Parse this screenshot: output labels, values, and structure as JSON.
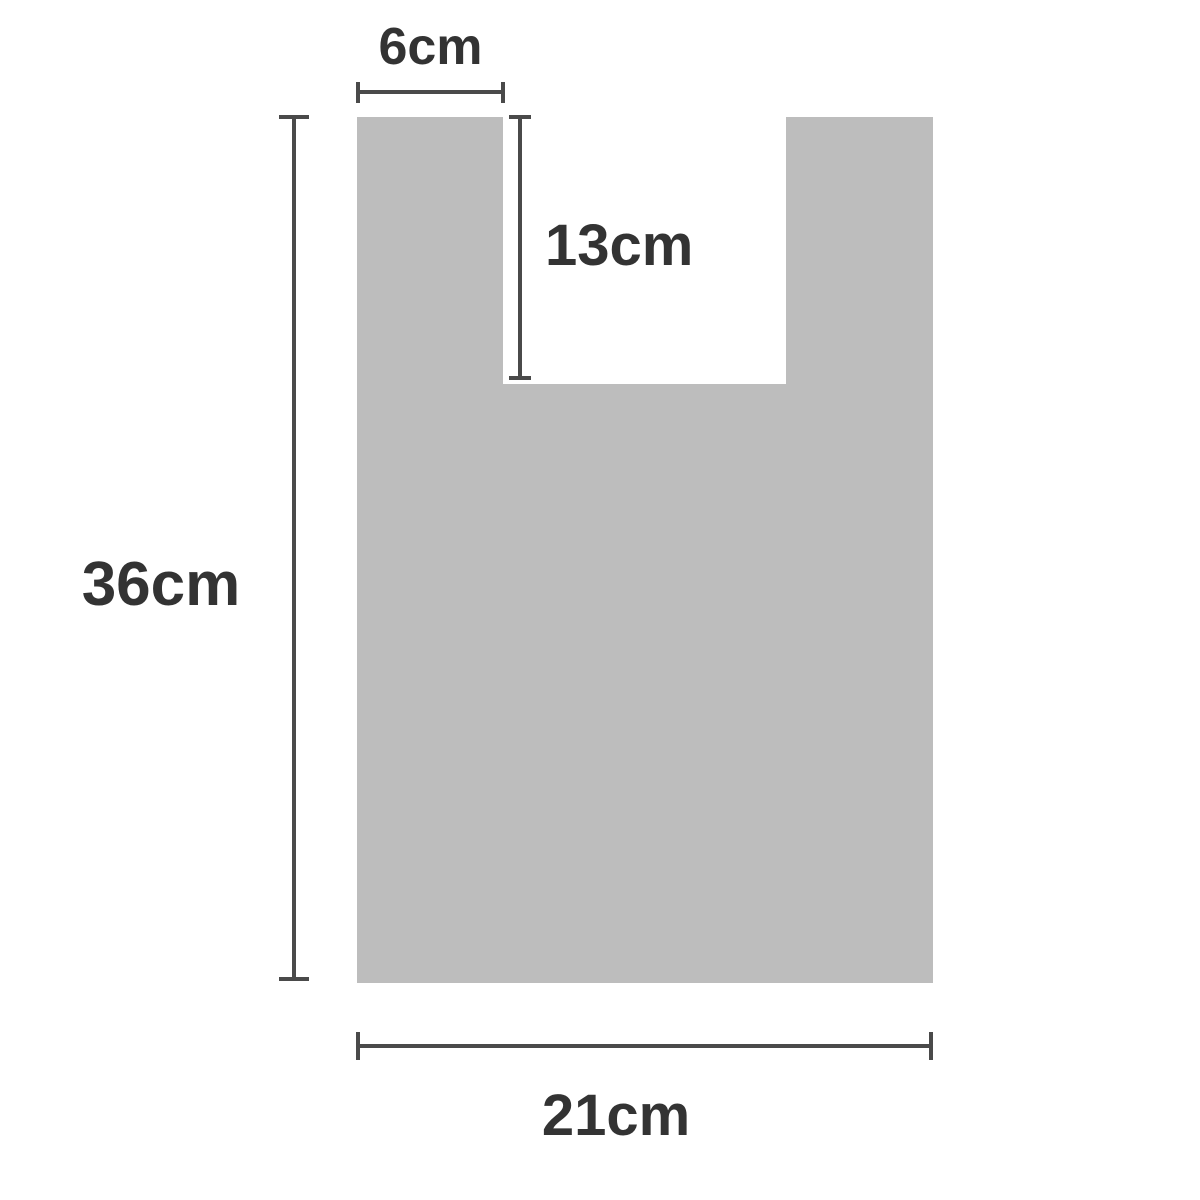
{
  "diagram": {
    "background_color": "#ffffff",
    "shape": {
      "name": "vest-bag-panel",
      "fill_color": "#bdbdbd"
    },
    "style": {
      "line_color": "#4a4a4a",
      "text_color": "#333333"
    },
    "dimensions": [
      {
        "id": "handle-width",
        "label": "6cm"
      },
      {
        "id": "handle-cut-depth",
        "label": "13cm"
      },
      {
        "id": "bag-height",
        "label": "36cm"
      },
      {
        "id": "bag-width",
        "label": "21cm"
      }
    ]
  }
}
